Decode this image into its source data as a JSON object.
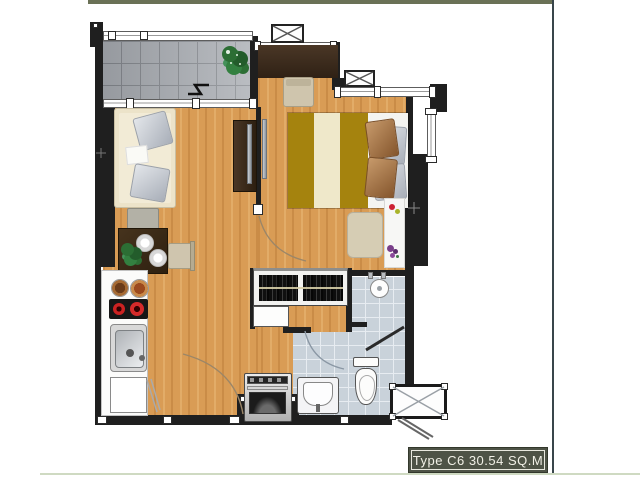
{
  "title_plate": {
    "text": "Type C6 30.54 SQ.M",
    "unit_type": "C6",
    "area": "30.54 SQ.M"
  },
  "theme": {
    "top_bar_color": "#6a7156",
    "right_rule_color": "#39464b",
    "bottom_rule_color": "#cfdac2",
    "wall_color": "#1f1f1f",
    "wood_floor_color": "#d99c55",
    "balcony_tile_color": "#a7abb1",
    "bathroom_tile_color": "#c9d2da",
    "bed_gold_color": "#a5830e",
    "bed_cream_color": "#efe8ca",
    "plate_bg_color": "#4e5346",
    "plate_text_color": "#f1f0e6"
  }
}
